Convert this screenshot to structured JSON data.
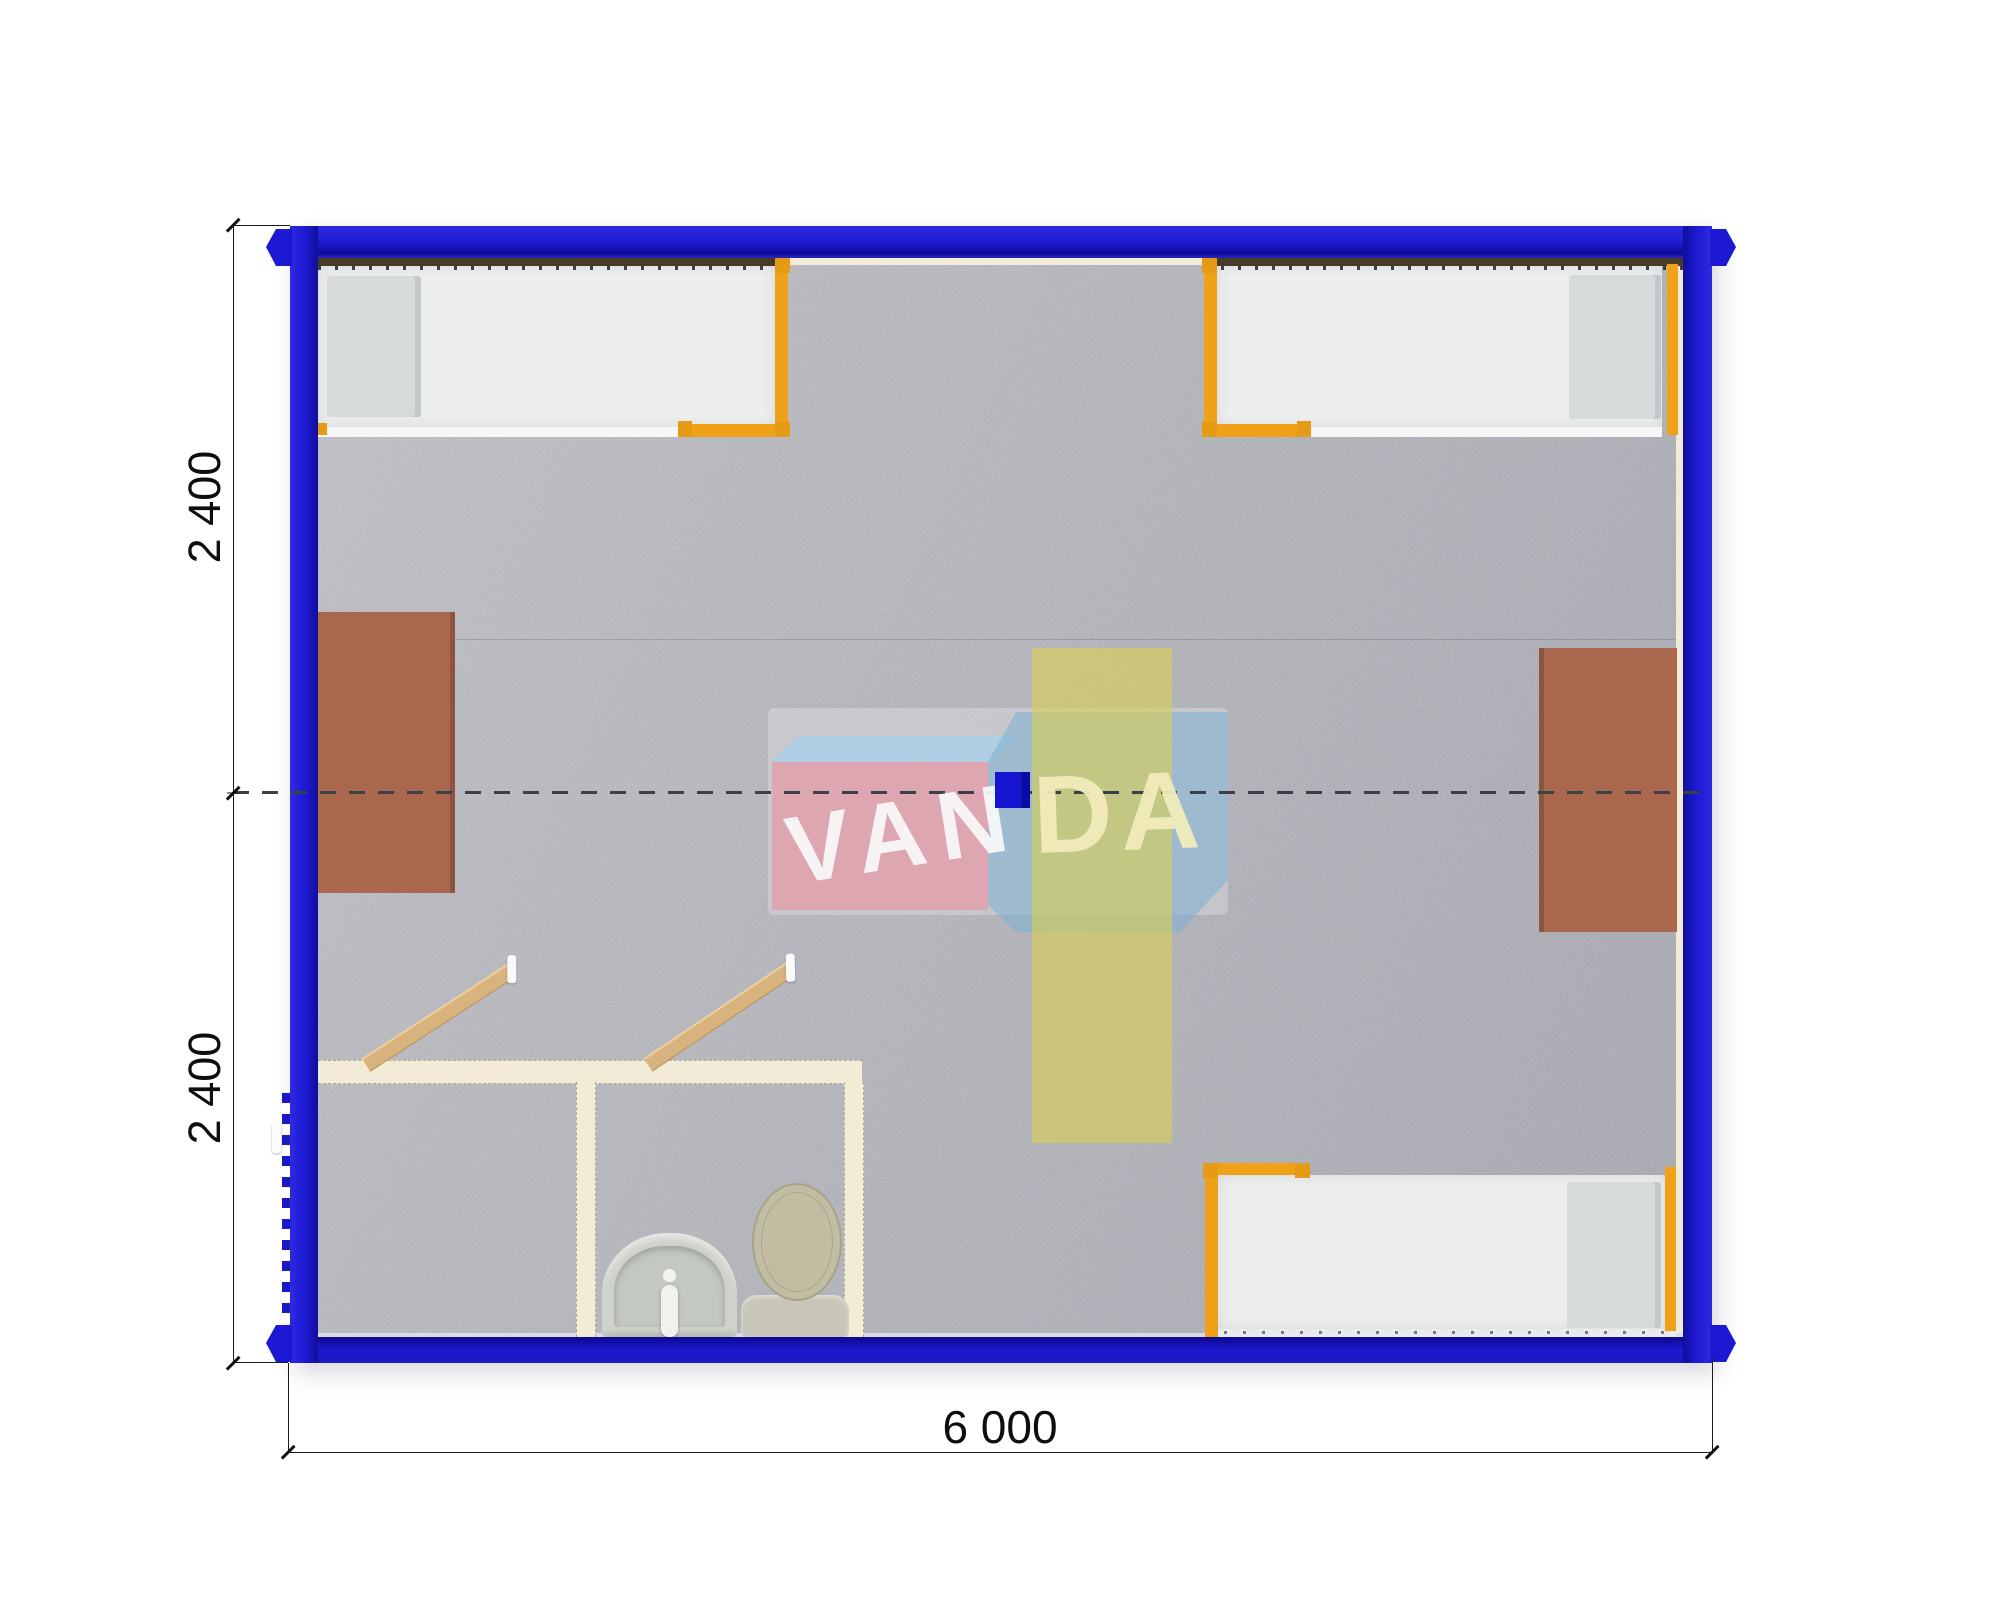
{
  "plan": {
    "title": "VANDA modular container cabin floor plan",
    "watermark": {
      "text_left": "VAN",
      "text_right": "DA",
      "brand": "VANDA"
    },
    "dimensions": {
      "bottom_width": "6 000",
      "left_top": "2 400",
      "left_bottom": "2 400"
    },
    "colors": {
      "frame_blue": "#1d19d2",
      "bed_orange": "#efa117",
      "table_brown": "#a9674d",
      "floor_gray": "#b4b4bd",
      "wall_cream": "#f2ecd6"
    },
    "furniture": {
      "beds": 3,
      "tables": 2,
      "bathroom_fixtures": [
        "sink",
        "toilet"
      ],
      "doors": 2
    }
  }
}
